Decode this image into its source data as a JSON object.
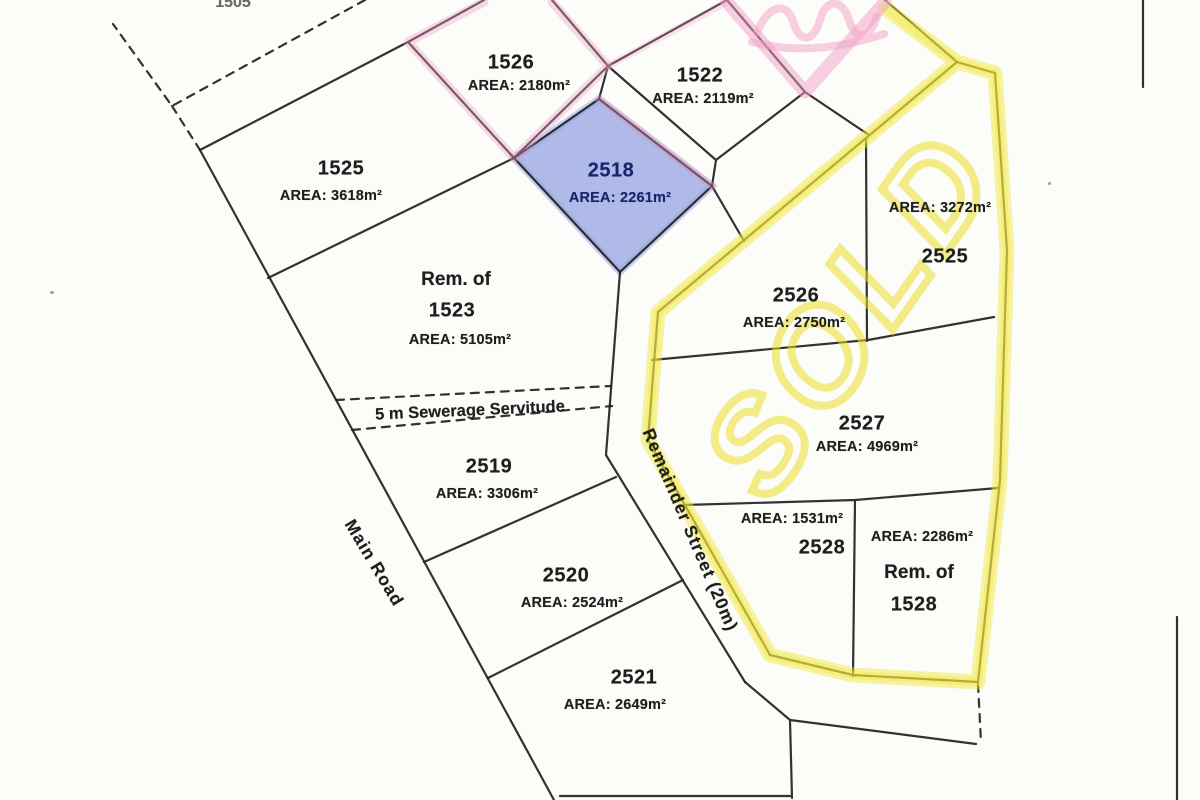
{
  "annotations": {
    "sold_text": "SOLD",
    "servitude": "5 m Sewerage Servitude",
    "main_road": "Main Road",
    "remainder_street": "Remainder Street (20m)",
    "neighbor_top": "1505"
  },
  "parcels": {
    "p1526": {
      "num": "1526",
      "area": "AREA: 2180m²"
    },
    "p1522": {
      "num": "1522",
      "area": "AREA: 2119m²"
    },
    "p1525": {
      "num": "1525",
      "area": "AREA: 3618m²"
    },
    "p2518": {
      "num": "2518",
      "area": "AREA: 2261m²",
      "highlight": "blue"
    },
    "rem1523": {
      "prefix": "Rem. of",
      "num": "1523",
      "area": "AREA: 5105m²"
    },
    "p2526": {
      "num": "2526",
      "area": "AREA: 2750m²"
    },
    "p2525": {
      "num": "2525",
      "area": "AREA: 3272m²"
    },
    "p2527": {
      "num": "2527",
      "area": "AREA: 4969m²"
    },
    "p2528": {
      "num": "2528",
      "area": "AREA: 1531m²"
    },
    "rem1528": {
      "prefix": "Rem. of",
      "num": "1528",
      "area": "AREA: 2286m²"
    },
    "p2519": {
      "num": "2519",
      "area": "AREA: 3306m²"
    },
    "p2520": {
      "num": "2520",
      "area": "AREA: 2524m²"
    },
    "p2521": {
      "num": "2521",
      "area": "AREA: 2649m²"
    }
  },
  "colors": {
    "paper": "#fcfcf9",
    "line": "#212121",
    "highlight_yellow": "#f2e83c",
    "highlight_pink": "#ef9fc7",
    "parcel_blue_fill": "#a9b4e6",
    "parcel_blue_text": "#18246d",
    "ink": "#1e1e1e"
  }
}
